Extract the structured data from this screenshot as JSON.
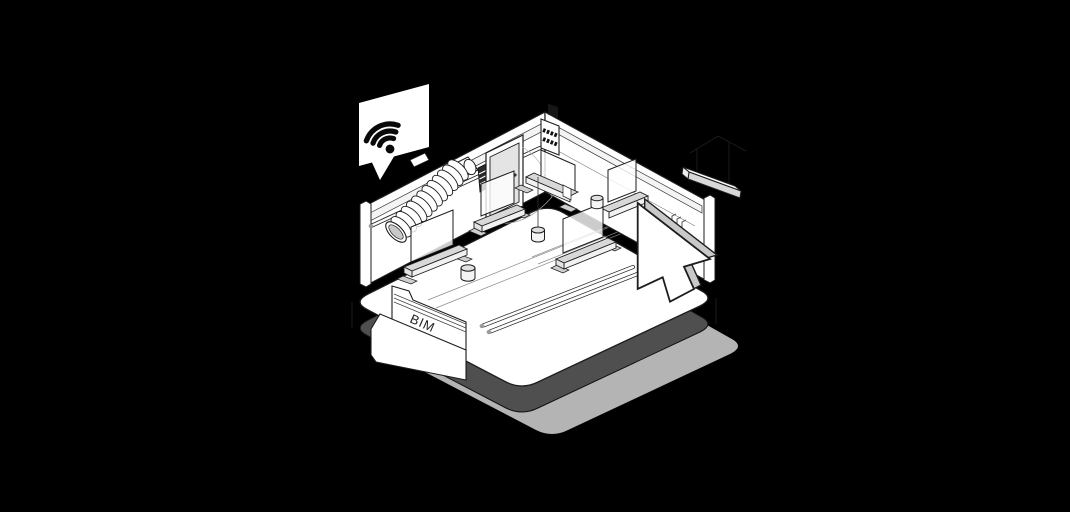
{
  "scene": {
    "colors": {
      "background": "#000000",
      "line": "#1d1d1d",
      "white": "#ffffff",
      "light_gray": "#d8d8d8",
      "mid_gray": "#c9c9c9",
      "platform_side": "#4f4f4f",
      "shadow": "#b4b4b4",
      "door": "#e4e4e4"
    }
  },
  "labels": {
    "folder": "BIM"
  },
  "icons": [
    "wifi-icon",
    "speech-bubble",
    "cursor-icon",
    "folder-icon",
    "pendant-light-icon",
    "flex-duct-icon",
    "electrical-panel-icon",
    "door-icon",
    "trestle-workbench-icon",
    "paint-bucket-icon",
    "floor-pipes-icon"
  ]
}
